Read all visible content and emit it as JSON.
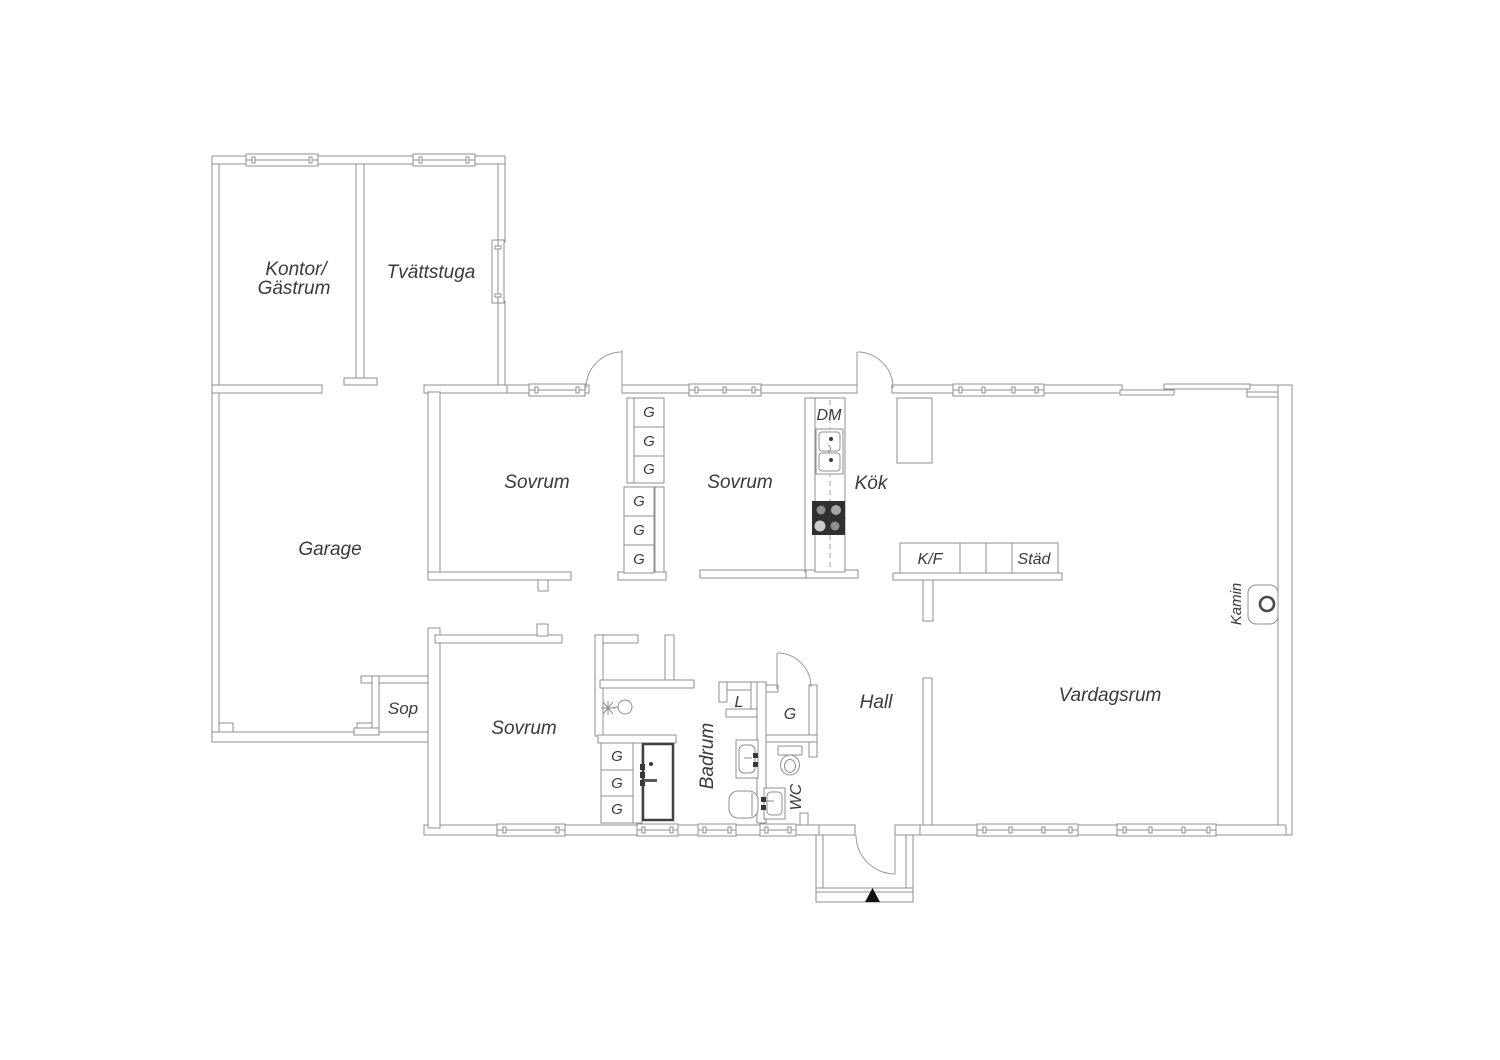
{
  "plan": {
    "type": "floor-plan",
    "colors": {
      "background": "#ffffff",
      "wall": "#8f8f8f",
      "text": "#3a3a3a",
      "stove": "#303030",
      "entrance_marker": "#111111"
    },
    "labels": {
      "kontor_line1": "Kontor/",
      "kontor_line2": "Gästrum",
      "tvattstuga": "Tvättstuga",
      "garage": "Garage",
      "sovrum": "Sovrum",
      "kok": "Kök",
      "dm": "DM",
      "kf": "K/F",
      "stad": "Städ",
      "hall": "Hall",
      "vardagsrum": "Vardagsrum",
      "kamin": "Kamin",
      "badrum": "Badrum",
      "wc": "WC",
      "linen": "L",
      "wardrobe": "G",
      "sop": "Sop"
    },
    "rooms": [
      "Kontor/Gästrum",
      "Tvättstuga",
      "Garage",
      "Sovrum",
      "Sovrum",
      "Sovrum",
      "Kök",
      "Hall",
      "Vardagsrum",
      "Badrum",
      "WC",
      "Sop"
    ]
  }
}
